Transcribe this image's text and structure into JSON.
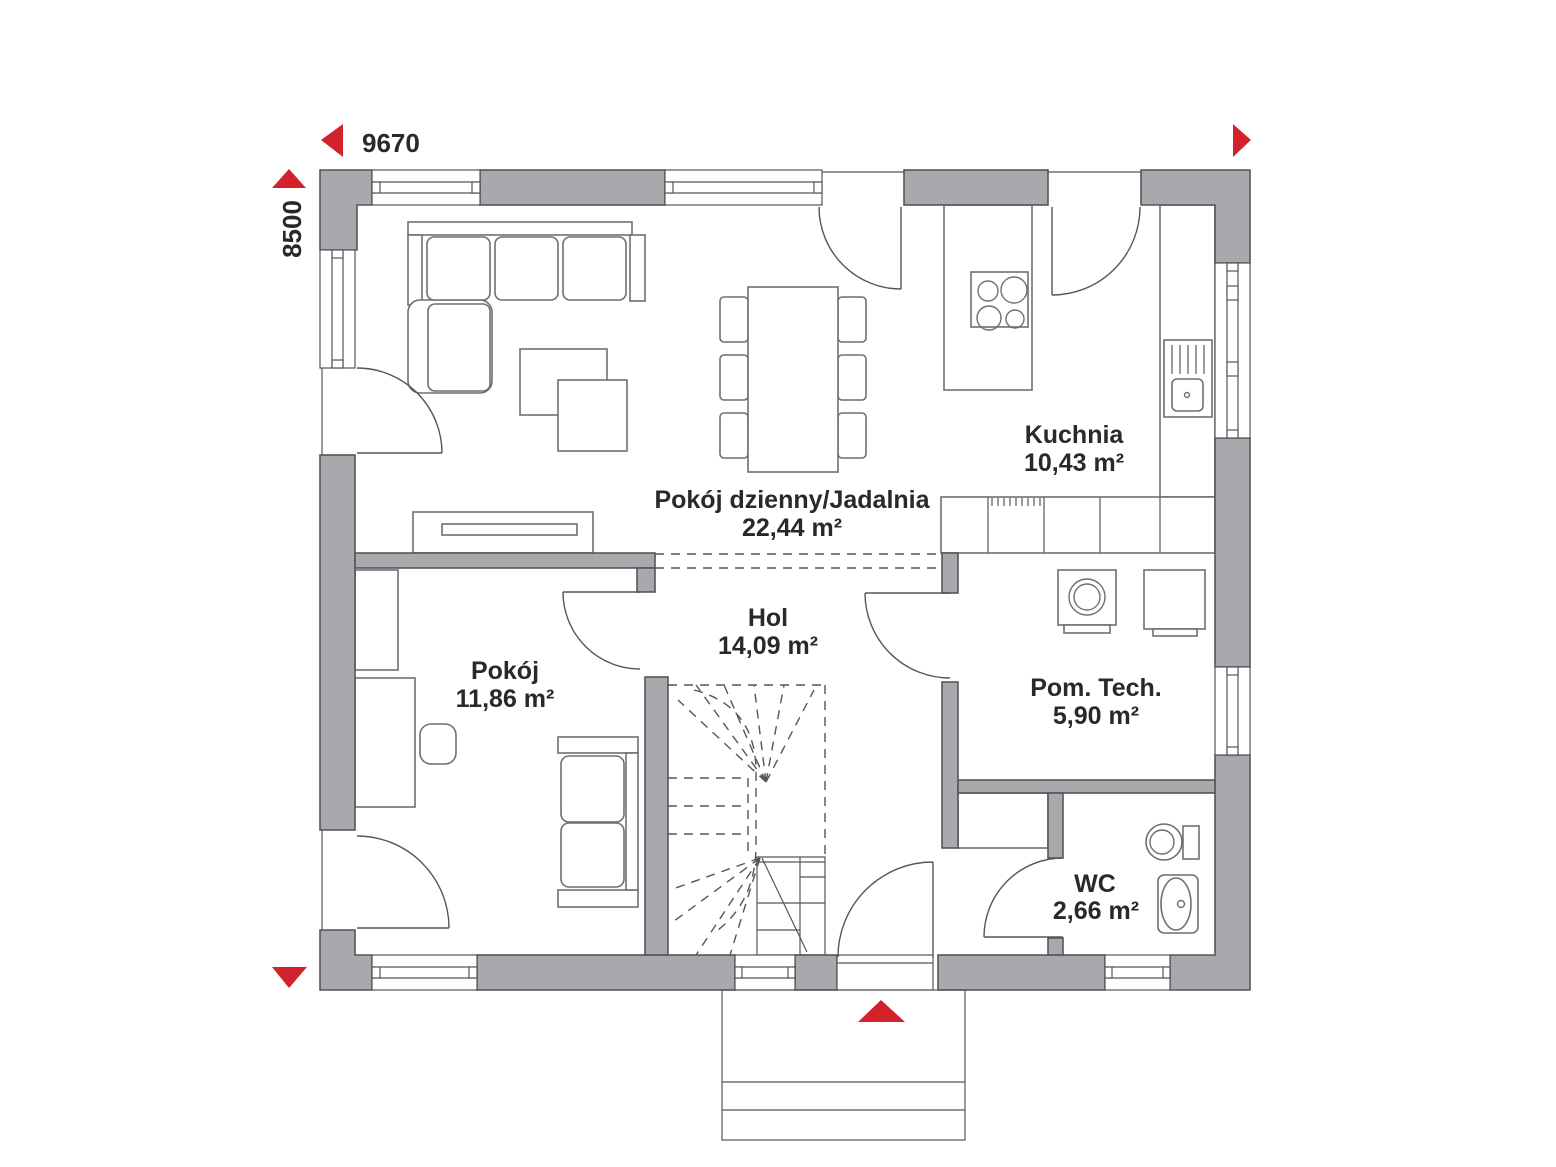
{
  "dimensions": {
    "width": "9670",
    "height": "8500"
  },
  "rooms": [
    {
      "name": "Kuchnia",
      "area": "10,43 m²"
    },
    {
      "name": "Pokój dzienny/Jadalnia",
      "area": "22,44 m²"
    },
    {
      "name": "Hol",
      "area": "14,09 m²"
    },
    {
      "name": "Pokój",
      "area": "11,86 m²"
    },
    {
      "name": "Pom. Tech.",
      "area": "5,90 m²"
    },
    {
      "name": "WC",
      "area": "2,66 m²"
    }
  ],
  "colors": {
    "wall_fill": "#a8a9ad",
    "outline": "#55565a",
    "furniture_line": "#6e6f73",
    "accent_red": "#d2232c",
    "text": "#2b2926",
    "background": "#ffffff"
  }
}
